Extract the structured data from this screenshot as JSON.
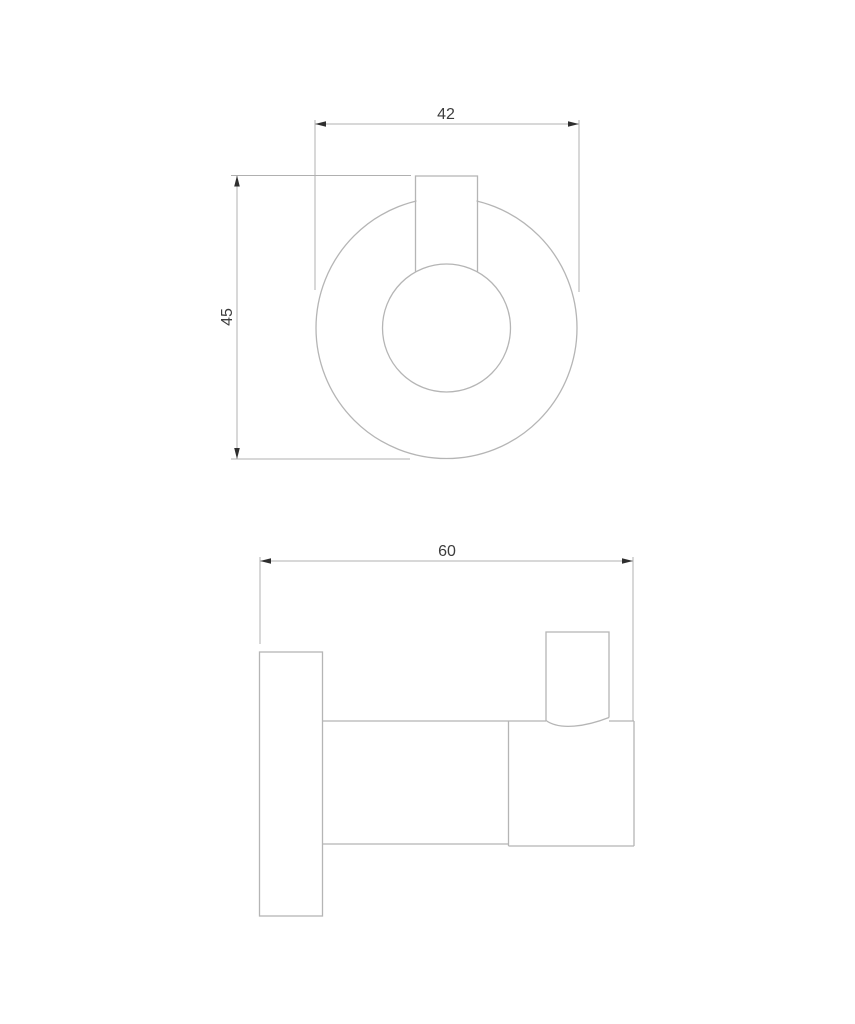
{
  "colors": {
    "bg": "#ffffff",
    "line-color": "#b5b5b5",
    "dim-color": "#b0b0b0",
    "arrow-color": "#2f2f2f",
    "text-color": "#3c3c3c"
  },
  "dimensions": {
    "front_width": {
      "label": "42",
      "orientation": "horizontal"
    },
    "front_height": {
      "label": "45",
      "orientation": "vertical"
    },
    "side_depth": {
      "label": "60",
      "orientation": "horizontal"
    }
  }
}
